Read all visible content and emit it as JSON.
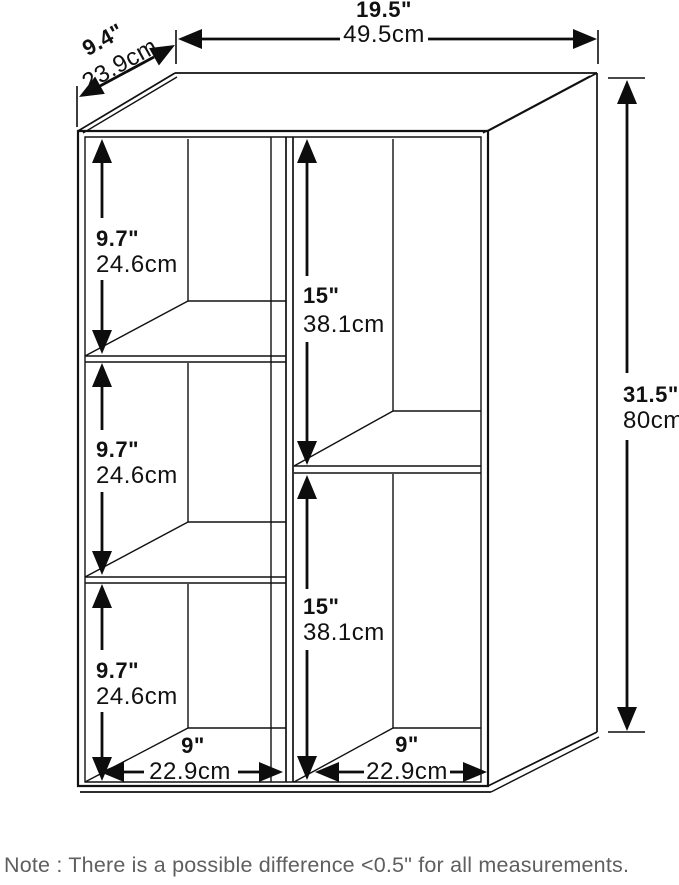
{
  "figure": {
    "kind": "furniture-dimension-diagram",
    "line_color": "#111111",
    "background": "#ffffff",
    "note_color": "#5f5f5f"
  },
  "dimensions": {
    "overall_width": {
      "inches": "19.5\"",
      "centimeters": "49.5cm"
    },
    "overall_depth": {
      "inches": "9.4\"",
      "centimeters": "23.9cm"
    },
    "overall_height": {
      "inches": "31.5\"",
      "centimeters": "80cm"
    },
    "left_compartments": [
      {
        "inches": "9.7\"",
        "centimeters": "24.6cm"
      },
      {
        "inches": "9.7\"",
        "centimeters": "24.6cm"
      },
      {
        "inches": "9.7\"",
        "centimeters": "24.6cm"
      }
    ],
    "right_compartments": [
      {
        "inches": "15\"",
        "centimeters": "38.1cm"
      },
      {
        "inches": "15\"",
        "centimeters": "38.1cm"
      }
    ],
    "compartment_widths": [
      {
        "inches": "9\"",
        "centimeters": "22.9cm"
      },
      {
        "inches": "9\"",
        "centimeters": "22.9cm"
      }
    ]
  },
  "note": {
    "text": "Note : There is a possible difference <0.5\" for all measurements."
  }
}
